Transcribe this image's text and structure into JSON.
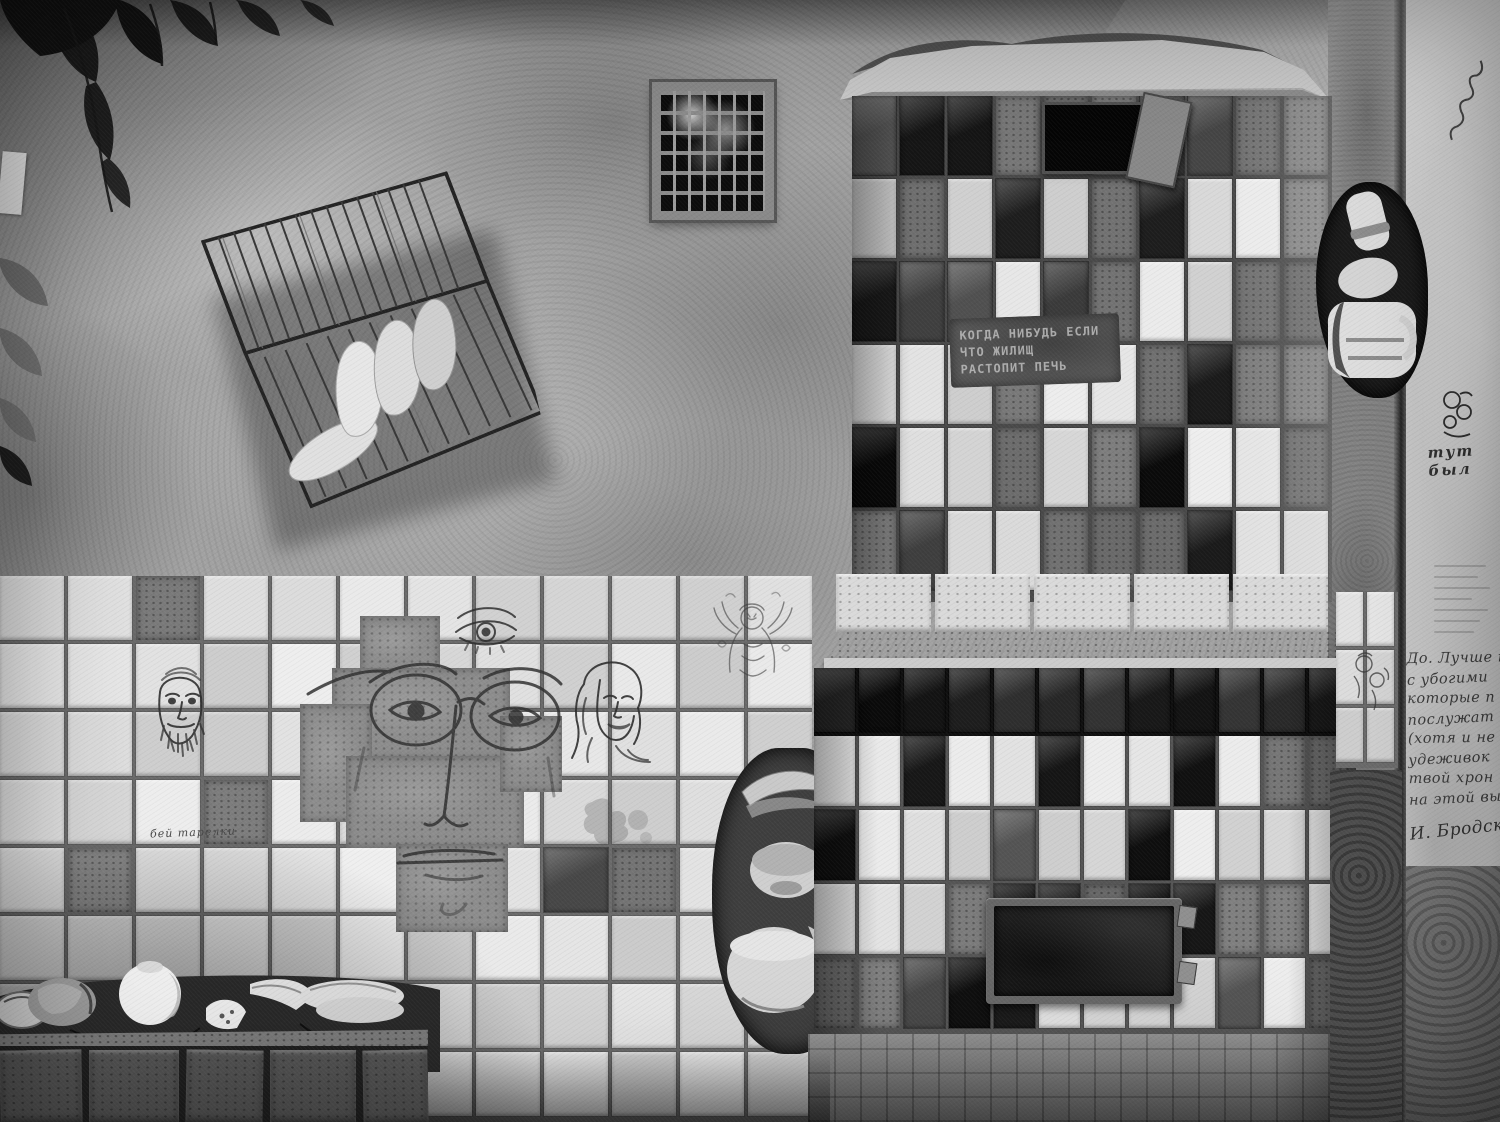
{
  "meta": {
    "alt": "Black-and-white photograph: courtyard wall with silver plaster, white tiled wall bearing ink face drawings, a wire dish rack, a ventilation grille, a two-tier tiled stove with stencilled verse, broken crockery and handwritten Brodsky lines on the side wall"
  },
  "texts": {
    "stove_stencil": {
      "line1": "КОГДА НИБУДЬ ЕСЛИ",
      "line2": "ЧТО ЖИЛИЩ",
      "line3": "РАСТОПИТ ПЕЧЬ"
    },
    "tile_note": "бей тарелки",
    "wall_graffiti": "тут был",
    "poem": {
      "line1": "До. Лучше к",
      "line2": "с убогими",
      "line3": "которые п",
      "line4": "послужат",
      "line5": "(хотя и не с",
      "line6": "удеживок",
      "line7": "твой хрон",
      "line8": "на этой вы",
      "signature": "И. Бродск"
    }
  },
  "palette": {
    "plaster": "#a3a19c",
    "tile_white": "#e3e1d9",
    "tile_dark": "#1c1c1c",
    "grout": "#6f6b63",
    "right_wall": "#c6c4bf",
    "ink": "#3a332c"
  }
}
